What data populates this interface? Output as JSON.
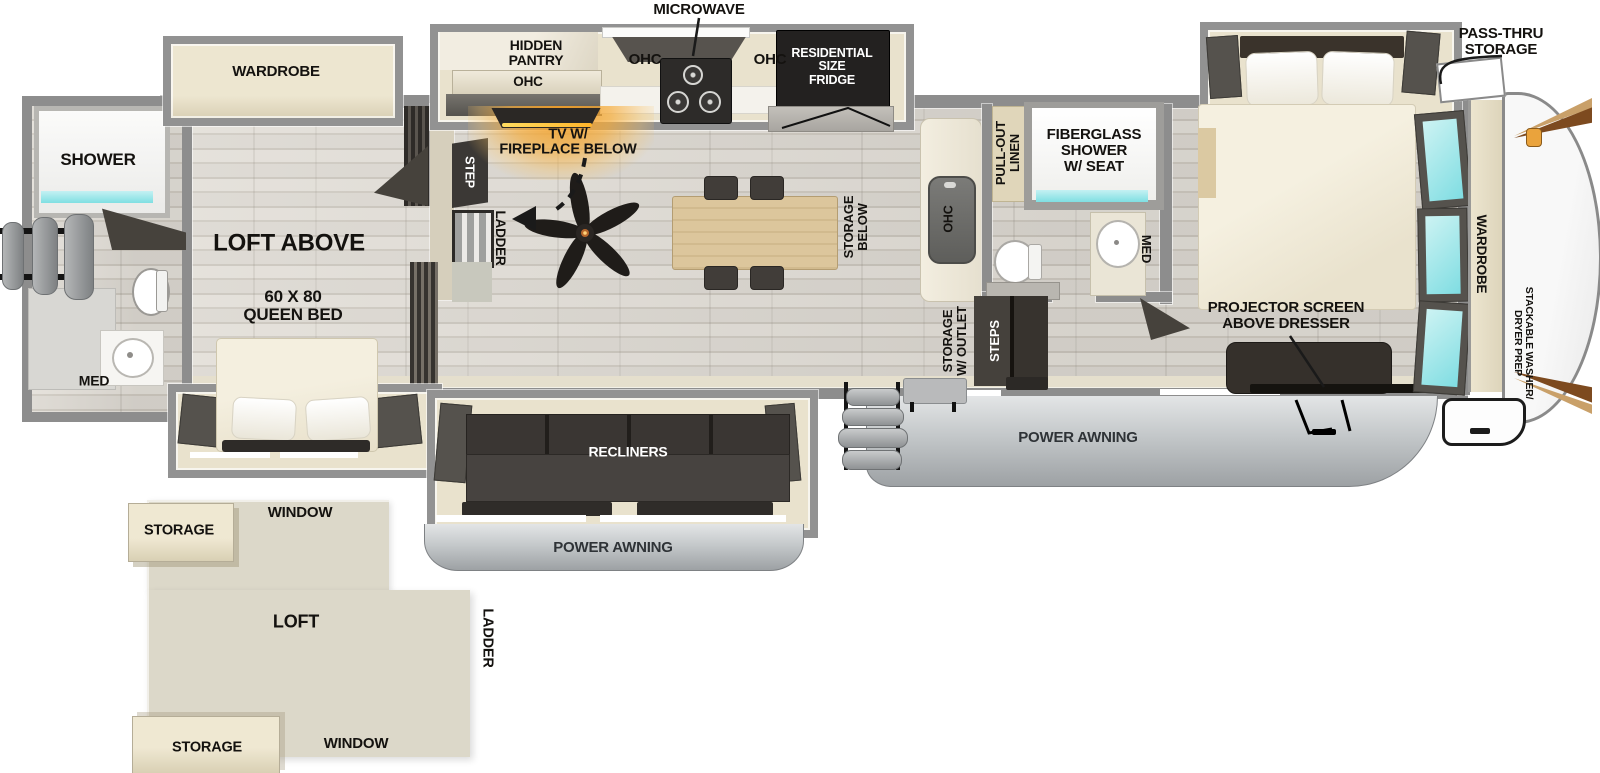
{
  "colors": {
    "wall": "#8d8d8d",
    "floor": "#d8d4cc",
    "cabinet_beige": "#e9e2cd",
    "dark_furniture": "#35312c",
    "window_cyan": "#7fdde2",
    "fireplace_orange": "#f2a93b",
    "awning_gray": "#a9adb0",
    "table_wood": "#d8c196"
  },
  "main_floorplan": {
    "exterior": {
      "pass_thru_storage": "PASS-THRU\nSTORAGE",
      "power_awning_door_side": "POWER AWNING",
      "power_awning_front": "POWER AWNING"
    },
    "kitchen": {
      "microwave": "MICROWAVE",
      "hidden_pantry": "HIDDEN\nPANTRY",
      "ohc_pantry": "OHC",
      "ohc_left": "OHC",
      "ohc_right": "OHC",
      "fridge": "RESIDENTIAL\nSIZE\nFRIDGE",
      "sink_ohc": "OHC",
      "storage_below": "STORAGE\nBELOW"
    },
    "living_room": {
      "tv_fireplace": "TV W/\nFIREPLACE BELOW",
      "recliners": "RECLINERS",
      "step": "STEP",
      "ladder": "LADDER"
    },
    "rear_bath": {
      "shower": "SHOWER",
      "med": "MED"
    },
    "rear_bedroom": {
      "wardrobe": "WARDROBE",
      "loft_above": "LOFT ABOVE",
      "queen_bed": "60 X 80\nQUEEN BED"
    },
    "mid_bath": {
      "pull_out_linen": "PULL-OUT\nLINEN",
      "fiberglass_shower": "FIBERGLASS\nSHOWER\nW/ SEAT",
      "med": "MED"
    },
    "entry": {
      "storage_w_outlet": "STORAGE\nW/ OUTLET",
      "steps": "STEPS"
    },
    "front_bedroom": {
      "projector_screen": "PROJECTOR SCREEN\nABOVE DRESSER",
      "wardrobe": "WARDROBE",
      "stackable_washer_dryer": "STACKABLE WASHER/\nDRYER PREP"
    }
  },
  "loft_inset": {
    "storage_top": "STORAGE",
    "window_top": "WINDOW",
    "loft": "LOFT",
    "ladder": "LADDER",
    "window_bottom": "WINDOW",
    "storage_bottom": "STORAGE"
  }
}
